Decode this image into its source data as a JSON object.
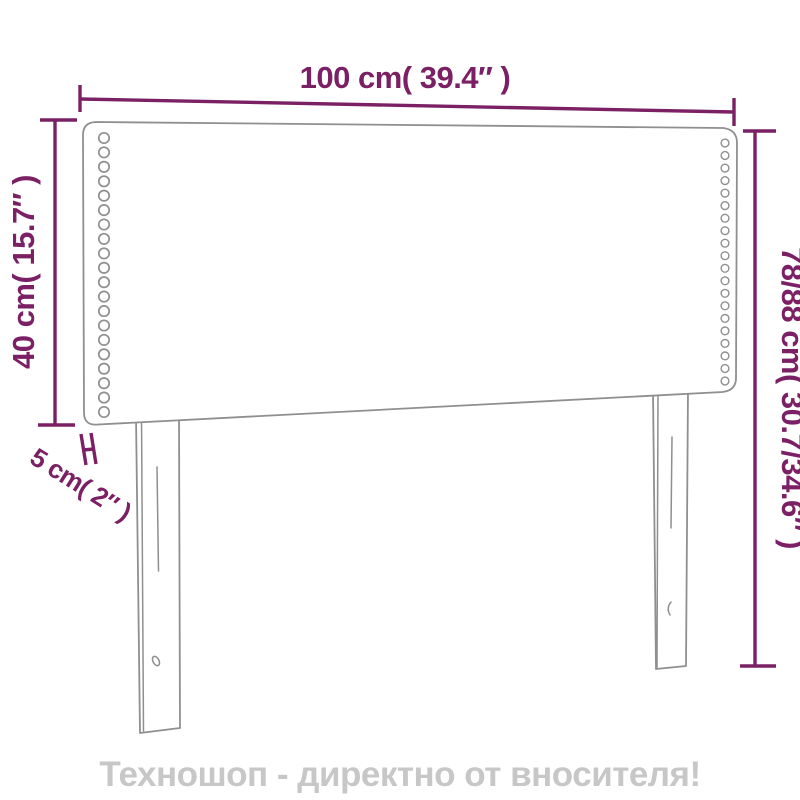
{
  "page": {
    "background_color": "#ffffff",
    "footer": {
      "text": "Техношоп - директно от вносителя!",
      "color": "#c7c7c7"
    }
  },
  "diagram": {
    "subject": "upholstered-headboard-dimension-drawing",
    "accent_color": "#7b2064",
    "outline_color": "#8f8f8f",
    "dimensions": {
      "width": "100 cm( 39.4″ )",
      "height_left": "40 cm( 15.7″ )",
      "height_right": "78/88 cm( 30.7/34.6″ )",
      "depth": "5 cm( 2″ )"
    },
    "nails": {
      "left_count": 20,
      "right_count": 20
    }
  }
}
